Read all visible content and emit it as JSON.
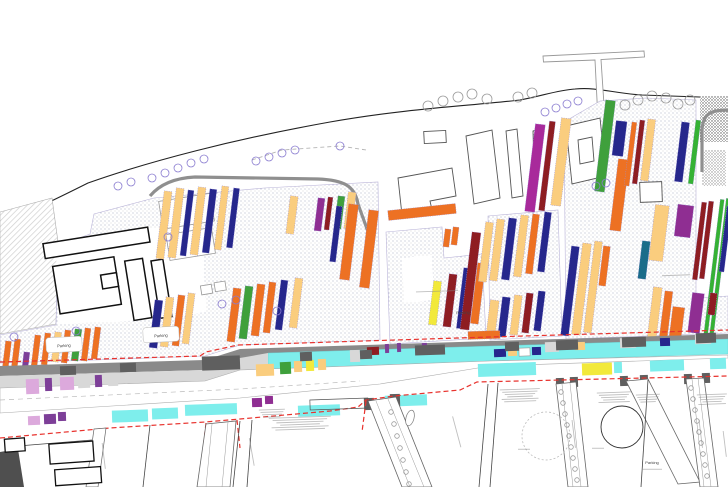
{
  "map": {
    "palette": {
      "orange": "#ED7123",
      "navy": "#26278C",
      "sand": "#FACD7E",
      "darkred": "#8E1D22",
      "purple": "#8F2E92",
      "magenta": "#A82A9B",
      "green": "#3FA03C",
      "green2": "#35B234",
      "teal": "#1A6C8A",
      "yellow": "#F2E93B",
      "cyan": "#7EEEEC",
      "pink": "#DCA9DC",
      "violet2": "#7D3F98",
      "lgray": "#D8D8D8",
      "white": "#FFFFFF",
      "road_gray": "#8A8A8A",
      "road_dark": "#5F5F5F",
      "red_dash": "#E8322D",
      "tree_violet": "#8A7CD0",
      "tree_gray": "#9B9B9B"
    },
    "labels": [
      {
        "text": "Parking",
        "x": 64,
        "y": 347,
        "rot": -3,
        "size": 4
      },
      {
        "text": "Parking",
        "x": 161,
        "y": 337,
        "rot": -3,
        "size": 4
      },
      {
        "text": "Parking",
        "x": 463,
        "y": 314,
        "rot": -2,
        "size": 4
      },
      {
        "text": "Parking",
        "x": 652,
        "y": 464,
        "rot": 0,
        "size": 4
      }
    ],
    "bars": [
      [
        4,
        341,
        6,
        26,
        "orange"
      ],
      [
        13,
        339,
        6,
        29,
        "orange"
      ],
      [
        23,
        352,
        6,
        15,
        "violet2"
      ],
      [
        33,
        335,
        6,
        31,
        "orange"
      ],
      [
        43,
        333,
        6,
        32,
        "orange"
      ],
      [
        53,
        332,
        7,
        30,
        "sand"
      ],
      [
        63,
        330,
        6,
        33,
        "orange"
      ],
      [
        73,
        329,
        7,
        32,
        "green"
      ],
      [
        83,
        328,
        6,
        33,
        "orange"
      ],
      [
        93,
        327,
        6,
        32,
        "orange"
      ],
      [
        152,
        300,
        8,
        48,
        "navy"
      ],
      [
        163,
        297,
        8,
        50,
        "sand"
      ],
      [
        175,
        295,
        7,
        51,
        "orange"
      ],
      [
        185,
        293,
        7,
        51,
        "sand"
      ],
      [
        230,
        288,
        8,
        54,
        "orange"
      ],
      [
        242,
        286,
        8,
        53,
        "green"
      ],
      [
        254,
        284,
        8,
        52,
        "orange"
      ],
      [
        266,
        282,
        7,
        51,
        "orange"
      ],
      [
        278,
        280,
        7,
        50,
        "navy"
      ],
      [
        292,
        278,
        8,
        50,
        "sand"
      ],
      [
        160,
        191,
        8,
        68,
        "sand"
      ],
      [
        172,
        188,
        8,
        70,
        "sand"
      ],
      [
        184,
        190,
        6,
        66,
        "navy"
      ],
      [
        194,
        187,
        8,
        68,
        "sand"
      ],
      [
        206,
        189,
        7,
        64,
        "navy"
      ],
      [
        218,
        186,
        7,
        64,
        "sand"
      ],
      [
        230,
        188,
        6,
        60,
        "navy"
      ],
      [
        288,
        196,
        8,
        38,
        "sand"
      ],
      [
        316,
        198,
        7,
        33,
        "purple"
      ],
      [
        326,
        197,
        5,
        33,
        "darkred"
      ],
      [
        336,
        196,
        7,
        33,
        "green"
      ],
      [
        346,
        192,
        8,
        37,
        "sand"
      ],
      [
        333,
        206,
        6,
        56,
        "navy"
      ],
      [
        344,
        204,
        10,
        76,
        "orange"
      ],
      [
        364,
        210,
        10,
        78,
        "orange"
      ],
      [
        388,
        207,
        68,
        10,
        "orange",
        -6
      ],
      [
        444,
        229,
        6,
        18,
        "orange"
      ],
      [
        452,
        227,
        6,
        18,
        "orange"
      ],
      [
        431,
        281,
        8,
        44,
        "yellow"
      ],
      [
        446,
        274,
        8,
        53,
        "darkred"
      ],
      [
        460,
        268,
        10,
        61,
        "navy"
      ],
      [
        474,
        263,
        8,
        61,
        "orange"
      ],
      [
        466,
        232,
        9,
        98,
        "darkred"
      ],
      [
        482,
        222,
        8,
        60,
        "sand"
      ],
      [
        493,
        219,
        8,
        62,
        "sand"
      ],
      [
        505,
        218,
        8,
        62,
        "navy"
      ],
      [
        517,
        215,
        8,
        62,
        "sand"
      ],
      [
        529,
        214,
        7,
        60,
        "orange"
      ],
      [
        541,
        212,
        7,
        60,
        "navy"
      ],
      [
        488,
        300,
        9,
        38,
        "sand"
      ],
      [
        500,
        297,
        8,
        40,
        "navy"
      ],
      [
        512,
        295,
        8,
        40,
        "sand"
      ],
      [
        524,
        293,
        7,
        40,
        "darkred"
      ],
      [
        536,
        291,
        7,
        40,
        "navy"
      ],
      [
        530,
        124,
        10,
        88,
        "magenta"
      ],
      [
        544,
        121,
        6,
        90,
        "darkred"
      ],
      [
        556,
        118,
        10,
        88,
        "sand"
      ],
      [
        600,
        100,
        10,
        92,
        "green"
      ],
      [
        614,
        121,
        11,
        35,
        "navy"
      ],
      [
        614,
        159,
        11,
        72,
        "orange"
      ],
      [
        628,
        122,
        5,
        64,
        "orange"
      ],
      [
        636,
        120,
        5,
        64,
        "darkred"
      ],
      [
        644,
        119,
        8,
        62,
        "sand"
      ],
      [
        678,
        122,
        8,
        60,
        "navy"
      ],
      [
        692,
        120,
        5,
        64,
        "green2"
      ],
      [
        566,
        246,
        8,
        90,
        "navy"
      ],
      [
        577,
        243,
        9,
        92,
        "sand"
      ],
      [
        589,
        241,
        8,
        92,
        "sand"
      ],
      [
        601,
        246,
        7,
        40,
        "orange"
      ],
      [
        640,
        241,
        8,
        38,
        "teal"
      ],
      [
        652,
        205,
        14,
        56,
        "sand"
      ],
      [
        676,
        205,
        16,
        32,
        "purple"
      ],
      [
        697,
        202,
        5,
        78,
        "darkred"
      ],
      [
        704,
        201,
        5,
        78,
        "darkred"
      ],
      [
        712,
        199,
        4,
        136,
        "green2"
      ],
      [
        718,
        198,
        4,
        136,
        "green2"
      ],
      [
        650,
        287,
        9,
        56,
        "sand"
      ],
      [
        662,
        291,
        8,
        48,
        "orange"
      ],
      [
        671,
        307,
        12,
        30,
        "orange"
      ],
      [
        690,
        293,
        12,
        40,
        "purple"
      ],
      [
        709,
        293,
        7,
        22,
        "darkred"
      ],
      [
        723,
        206,
        5,
        66,
        "navy"
      ],
      [
        468,
        331,
        32,
        8,
        "orange",
        -2
      ]
    ],
    "median_segments": [
      [
        26,
        379,
        13,
        15,
        "pink"
      ],
      [
        45,
        378,
        7,
        13,
        "violet2"
      ],
      [
        60,
        377,
        14,
        13,
        "pink"
      ],
      [
        78,
        376,
        12,
        12,
        "lgray"
      ],
      [
        95,
        375,
        7,
        12,
        "violet2"
      ],
      [
        108,
        374,
        10,
        12,
        "lgray"
      ],
      [
        256,
        364,
        18,
        12,
        "sand"
      ],
      [
        280,
        362,
        11,
        12,
        "green"
      ],
      [
        294,
        361,
        8,
        11,
        "sand"
      ],
      [
        306,
        360,
        8,
        11,
        "yellow"
      ],
      [
        318,
        359,
        8,
        11,
        "sand"
      ],
      [
        350,
        350,
        10,
        12,
        "lgray"
      ],
      [
        367,
        347,
        12,
        8,
        "darkred"
      ],
      [
        385,
        344,
        4,
        9,
        "violet2"
      ],
      [
        397,
        343,
        4,
        9,
        "violet2"
      ],
      [
        422,
        343,
        5,
        9,
        "violet2"
      ],
      [
        494,
        349,
        12,
        8,
        "navy"
      ],
      [
        508,
        348,
        9,
        8,
        "sand"
      ],
      [
        519,
        348,
        11,
        8,
        "white"
      ],
      [
        532,
        347,
        9,
        8,
        "navy"
      ],
      [
        545,
        342,
        14,
        10,
        "lgray"
      ],
      [
        575,
        342,
        10,
        8,
        "sand"
      ],
      [
        620,
        338,
        16,
        10,
        "lgray"
      ],
      [
        660,
        338,
        10,
        8,
        "navy"
      ],
      [
        695,
        334,
        16,
        10,
        "lgray"
      ]
    ],
    "south_segments": [
      [
        28,
        416,
        12,
        9,
        "pink"
      ],
      [
        44,
        414,
        12,
        10,
        "violet2"
      ],
      [
        58,
        412,
        8,
        9,
        "violet2"
      ],
      [
        112,
        410,
        36,
        12,
        "cyan"
      ],
      [
        152,
        408,
        26,
        11,
        "cyan"
      ],
      [
        185,
        404,
        52,
        11,
        "cyan"
      ],
      [
        252,
        398,
        10,
        9,
        "purple"
      ],
      [
        265,
        396,
        8,
        8,
        "purple"
      ],
      [
        298,
        405,
        42,
        11,
        "cyan"
      ],
      [
        385,
        395,
        42,
        11,
        "cyan"
      ],
      [
        478,
        363,
        58,
        13,
        "cyan"
      ],
      [
        582,
        363,
        30,
        12,
        "yellow"
      ],
      [
        614,
        362,
        8,
        11,
        "cyan"
      ],
      [
        650,
        360,
        34,
        11,
        "cyan"
      ],
      [
        710,
        358,
        16,
        11,
        "cyan"
      ]
    ],
    "road_blocks": [
      [
        60,
        366,
        16,
        9
      ],
      [
        120,
        363,
        16,
        9
      ],
      [
        202,
        356,
        38,
        14
      ],
      [
        300,
        352,
        12,
        9
      ],
      [
        360,
        350,
        12,
        9
      ],
      [
        415,
        345,
        30,
        10
      ],
      [
        505,
        342,
        14,
        9
      ],
      [
        556,
        340,
        22,
        10
      ],
      [
        622,
        337,
        24,
        10
      ],
      [
        696,
        333,
        20,
        10
      ],
      [
        364,
        398,
        10,
        12
      ],
      [
        390,
        394,
        10,
        12
      ],
      [
        556,
        378,
        8,
        10
      ],
      [
        570,
        377,
        8,
        10
      ],
      [
        620,
        376,
        8,
        10
      ],
      [
        640,
        375,
        8,
        10
      ],
      [
        684,
        374,
        8,
        10
      ],
      [
        702,
        373,
        8,
        10
      ]
    ],
    "trees_violet": [
      [
        118,
        186
      ],
      [
        131,
        182
      ],
      [
        152,
        178
      ],
      [
        165,
        173
      ],
      [
        178,
        168
      ],
      [
        191,
        163
      ],
      [
        204,
        159
      ],
      [
        256,
        161
      ],
      [
        269,
        157
      ],
      [
        282,
        153
      ],
      [
        295,
        150
      ],
      [
        340,
        146
      ],
      [
        545,
        112
      ],
      [
        556,
        108
      ],
      [
        567,
        104
      ],
      [
        578,
        101
      ],
      [
        277,
        311
      ],
      [
        168,
        237
      ],
      [
        76,
        331
      ],
      [
        14,
        337
      ],
      [
        222,
        304
      ],
      [
        236,
        300
      ],
      [
        596,
        186
      ],
      [
        606,
        183
      ]
    ],
    "trees_gray": [
      [
        428,
        106
      ],
      [
        443,
        101
      ],
      [
        458,
        97
      ],
      [
        472,
        94
      ],
      [
        487,
        99
      ],
      [
        518,
        97
      ],
      [
        532,
        93
      ],
      [
        625,
        105
      ],
      [
        638,
        100
      ],
      [
        652,
        96
      ],
      [
        666,
        98
      ],
      [
        678,
        104
      ],
      [
        690,
        100
      ]
    ],
    "street_trees": [
      [
        391,
        412
      ],
      [
        394,
        424
      ],
      [
        397,
        436
      ],
      [
        400,
        448
      ],
      [
        403,
        460
      ],
      [
        406,
        472
      ],
      [
        409,
        484
      ],
      [
        561,
        392
      ],
      [
        563,
        403
      ],
      [
        565,
        414
      ],
      [
        567,
        425
      ],
      [
        569,
        436
      ],
      [
        571,
        447
      ],
      [
        573,
        458
      ],
      [
        575,
        469
      ],
      [
        577,
        480
      ],
      [
        691,
        388
      ],
      [
        693,
        399
      ],
      [
        695,
        410
      ],
      [
        697,
        421
      ],
      [
        699,
        432
      ],
      [
        701,
        443
      ],
      [
        703,
        454
      ],
      [
        705,
        465
      ],
      [
        707,
        476
      ]
    ],
    "blur_blocks": [
      [
        300,
        424,
        62,
        6,
        -2
      ],
      [
        272,
        414,
        26,
        4,
        -2
      ],
      [
        520,
        396,
        40,
        6,
        -2
      ],
      [
        614,
        398,
        34,
        5,
        -2
      ],
      [
        648,
        399,
        24,
        4,
        -2
      ],
      [
        712,
        400,
        30,
        5,
        -2
      ],
      [
        437,
        292,
        42,
        1,
        -2
      ],
      [
        676,
        276,
        28,
        1,
        -2
      ],
      [
        103,
        456,
        26,
        1,
        83
      ],
      [
        251,
        452,
        28,
        1,
        80
      ],
      [
        456,
        432,
        32,
        1,
        75
      ],
      [
        573,
        434,
        28,
        1,
        83
      ],
      [
        700,
        434,
        28,
        1,
        83
      ],
      [
        724,
        444,
        26,
        1,
        83
      ],
      [
        598,
        449,
        12,
        1,
        0
      ],
      [
        524,
        450,
        12,
        1,
        0
      ],
      [
        652,
        470,
        20,
        1,
        0
      ]
    ]
  }
}
